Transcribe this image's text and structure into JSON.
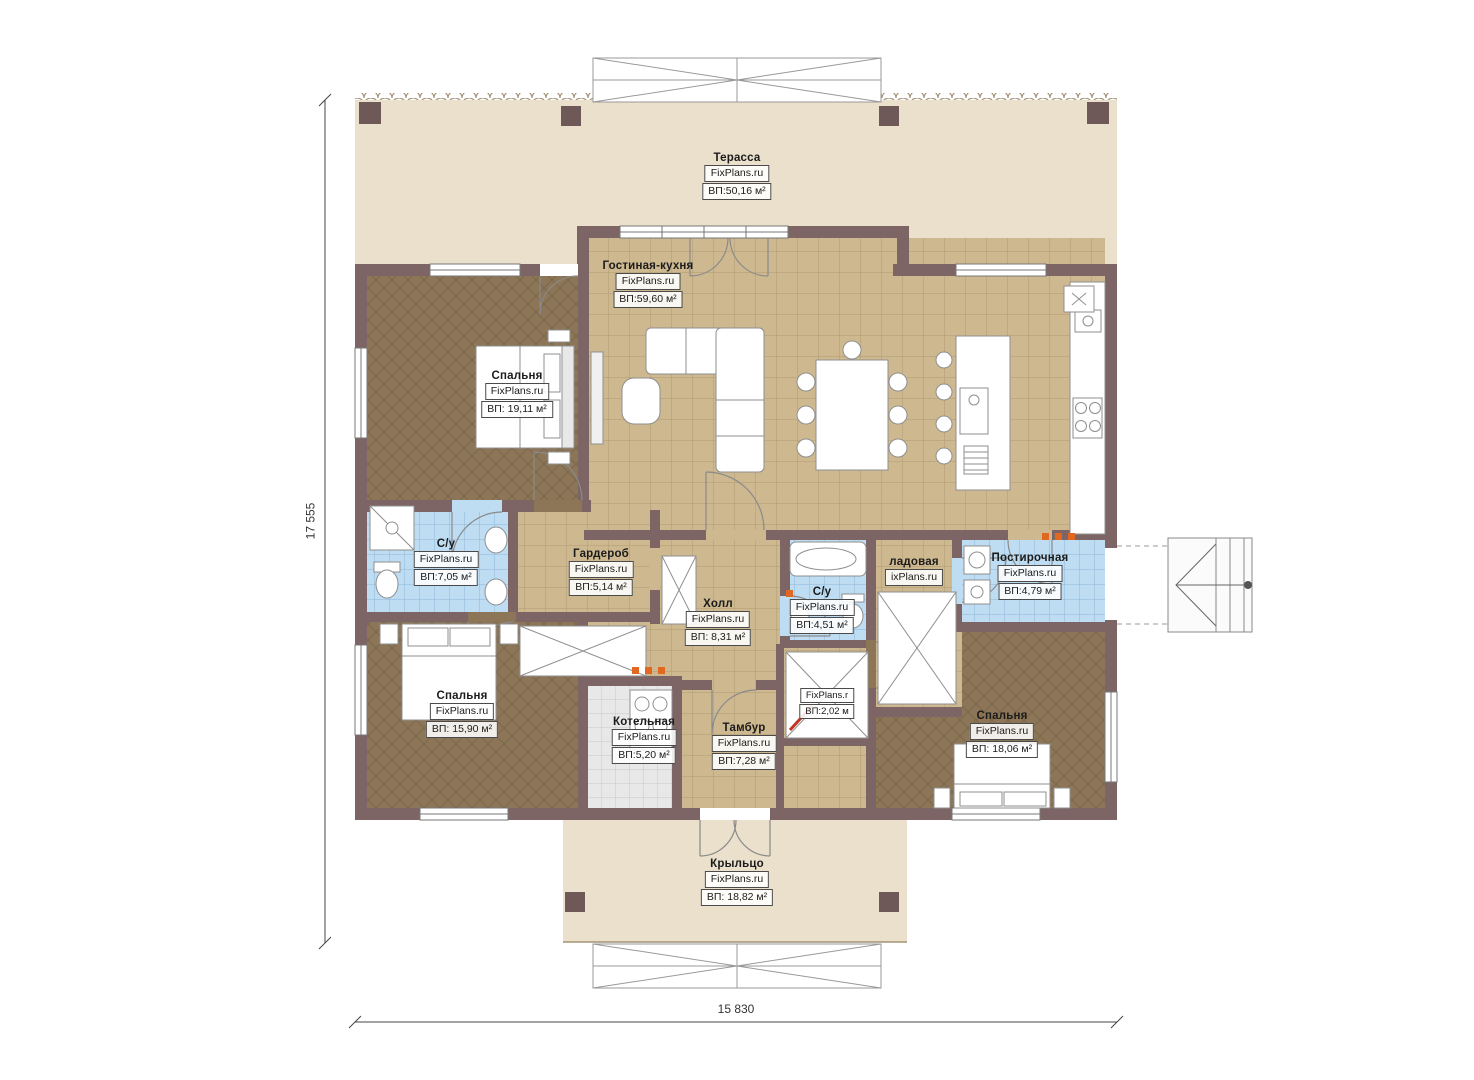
{
  "watermark": "FixPlans.ru",
  "dimensions": {
    "vertical": "17 555",
    "horizontal": "15 830"
  },
  "rooms": {
    "terrace": {
      "name": "Терасса",
      "area": "ВП:50,16 м²"
    },
    "living": {
      "name": "Гостиная-кухня",
      "area": "ВП:59,60 м²"
    },
    "bedroom1": {
      "name": "Спальня",
      "area": "ВП: 19,11 м²"
    },
    "bath1": {
      "name": "С/у",
      "area": "ВП:7,05 м²"
    },
    "wardrobe": {
      "name": "Гардероб",
      "area": "ВП:5,14 м²"
    },
    "hall": {
      "name": "Холл",
      "area": "ВП: 8,31 м²"
    },
    "bath2": {
      "name": "С/у",
      "area": "ВП:4,51 м²"
    },
    "pantry": {
      "name": "ладовая",
      "watermark": "ixPlans.ru"
    },
    "laundry": {
      "name": "Постирочная",
      "area": "ВП:4,79 м²"
    },
    "bedroom2": {
      "name": "Спальня",
      "area": "ВП: 15,90 м²"
    },
    "boiler": {
      "name": "Котельная",
      "area": "ВП:5,20 м²"
    },
    "tambur": {
      "name": "Тамбур",
      "area": "ВП:7,28 м²"
    },
    "closet": {
      "watermark": "FixPlans.r",
      "area": "ВП:2,02 м"
    },
    "bedroom3": {
      "name": "Спальня",
      "area": "ВП: 18,06 м²"
    },
    "porch": {
      "name": "Крыльцо",
      "area": "ВП: 18,82 м²"
    }
  },
  "colors": {
    "wall": "#7d6565",
    "terrace_floor": "#eae0cb",
    "tile_floor": "#cdb88f",
    "bedroom_floor": "#8d7657",
    "bathroom_floor": "#bedcf2",
    "boiler_floor": "#e8e8e8",
    "accent_dot": "#e06820"
  }
}
